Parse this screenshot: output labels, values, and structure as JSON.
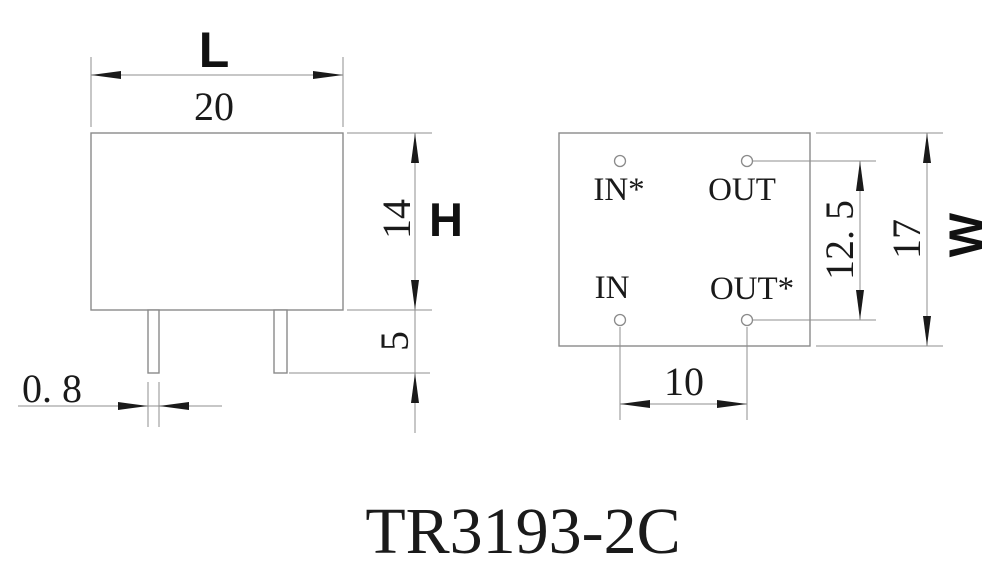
{
  "title": "TR3193-2C",
  "colors": {
    "background": "#ffffff",
    "line": "#8f8f8f",
    "ink": "#1a1a1a"
  },
  "front_view": {
    "length": {
      "symbol": "L",
      "value": "20"
    },
    "height": {
      "symbol": "H",
      "value": "14"
    },
    "pin_length": {
      "value": "5"
    },
    "pin_width": {
      "value": "0. 8"
    }
  },
  "bottom_view": {
    "pins": {
      "top_left": "IN*",
      "top_right": "OUT",
      "bottom_left": "IN",
      "bottom_right": "OUT*"
    },
    "hole_span": {
      "value": "12. 5"
    },
    "width": {
      "symbol": "W",
      "value": "17"
    },
    "pin_pitch": {
      "value": "10"
    }
  }
}
